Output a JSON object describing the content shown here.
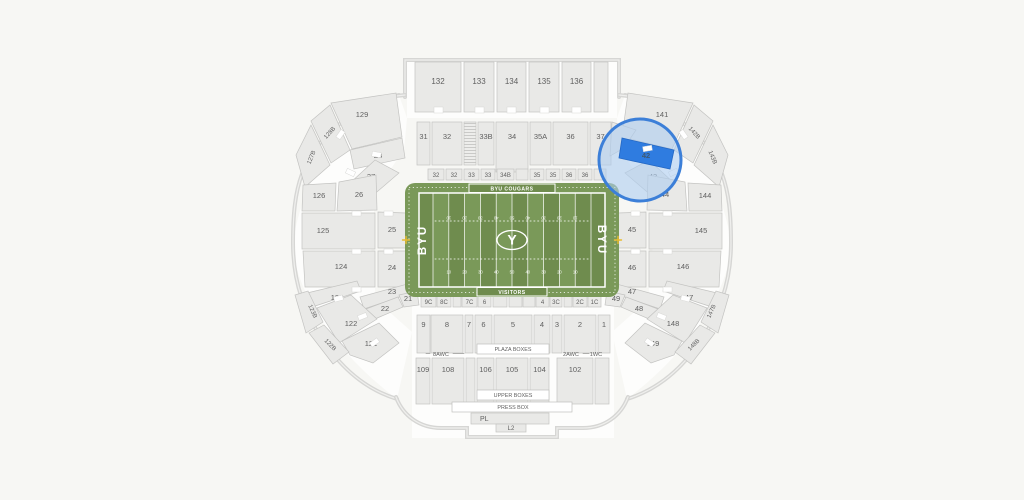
{
  "canvas": {
    "w": 1024,
    "h": 500,
    "bg": "#f7f7f4"
  },
  "colors": {
    "section": "#e9e9e7",
    "sectionStroke": "#c3c3c1",
    "wall": "#d6d6d4",
    "wallInner": "#efefed",
    "label": "#5f5f5f",
    "white": "#ffffff",
    "underlay": "#fdfdfc",
    "fieldBase": "#7a9959",
    "fieldDark": "#6f8c4e",
    "fieldLine": "#ffffff",
    "gold": "#e8bb30",
    "hlFill": "rgba(173,205,240,0.60)",
    "hlStroke": "#3c7fd8",
    "hlSection": "#2f7ce0",
    "hlSectionLabel": "#3f5a74"
  },
  "stadium": {
    "top_deck": {
      "y": 62,
      "h": 50,
      "label_y": 84,
      "boxes": [
        [
          "132",
          415,
          46
        ],
        [
          "133",
          464,
          30
        ],
        [
          "134",
          497,
          29
        ],
        [
          "135",
          529,
          30
        ],
        [
          "136",
          562,
          29
        ],
        [
          "",
          594,
          14
        ]
      ],
      "notch_y": 107,
      "notches_x": [
        438,
        479,
        511,
        544,
        576
      ]
    },
    "row2": {
      "y": 122,
      "h": 43,
      "label_y": 139,
      "boxes": [
        [
          "31",
          417,
          13,
          43
        ],
        [
          "32",
          432,
          30,
          43
        ],
        [
          "STAIRS",
          464,
          12,
          43
        ],
        [
          "33B",
          478,
          16,
          43
        ],
        [
          "34",
          496,
          32,
          50
        ],
        [
          "35A",
          530,
          21,
          43
        ],
        [
          "36",
          553,
          35,
          43
        ],
        [
          "37",
          590,
          21,
          43
        ]
      ]
    },
    "top_strip": {
      "y": 169,
      "h": 11,
      "label_y": 177,
      "boxes": [
        [
          "32",
          428,
          16
        ],
        [
          "32",
          446,
          16
        ],
        [
          "33",
          464,
          15
        ],
        [
          "33",
          481,
          14
        ],
        [
          "34B",
          497,
          17
        ],
        [
          "",
          516,
          12
        ],
        [
          "35",
          530,
          14
        ],
        [
          "35",
          546,
          14
        ],
        [
          "36",
          562,
          14
        ],
        [
          "36",
          578,
          14
        ],
        [
          "",
          594,
          12
        ]
      ]
    },
    "bottom_strip": {
      "y": 295,
      "h": 12,
      "label_y": 304,
      "boxes": [
        [
          "9C",
          421,
          15
        ],
        [
          "8C",
          437,
          14
        ],
        [
          "",
          453,
          8
        ],
        [
          "7C",
          462,
          15
        ],
        [
          "6",
          478,
          13
        ],
        [
          "",
          493,
          14
        ],
        [
          "",
          509,
          13
        ],
        [
          "",
          523,
          12
        ],
        [
          "4",
          536,
          13
        ],
        [
          "3C",
          550,
          12
        ],
        [
          "",
          564,
          8
        ],
        [
          "2C",
          573,
          14
        ],
        [
          "1C",
          588,
          13
        ]
      ]
    },
    "plaza_row": {
      "y": 315,
      "h": 38,
      "label_y": 327,
      "boxes": [
        [
          "9",
          417,
          13
        ],
        [
          "8",
          431,
          32
        ],
        [
          "7",
          465,
          8
        ],
        [
          "6",
          475,
          17
        ],
        [
          "5",
          494,
          38
        ],
        [
          "4",
          534,
          16
        ],
        [
          "3",
          552,
          10
        ],
        [
          "2",
          564,
          32
        ],
        [
          "1",
          598,
          12
        ]
      ],
      "band": {
        "label": "PLAZA BOXES",
        "x": 477,
        "y": 344,
        "w": 72,
        "h": 10,
        "label_x": 513,
        "label_y": 351
      },
      "wc_labels": [
        {
          "t": "8AWC",
          "x": 441,
          "y": 356
        },
        {
          "t": "2AWC",
          "x": 571,
          "y": 356
        },
        {
          "t": "1WC",
          "x": 596,
          "y": 356
        }
      ],
      "wc_dashes": [
        [
          453,
          353.5,
          464,
          353.5
        ],
        [
          583,
          353.5,
          589,
          353.5
        ],
        [
          426,
          353.5,
          430,
          353.5
        ]
      ]
    },
    "upper_row": {
      "y": 358,
      "h": 46,
      "label_y": 372,
      "boxes": [
        [
          "109",
          416,
          14
        ],
        [
          "108",
          432,
          32
        ],
        [
          "",
          466,
          9
        ],
        [
          "106",
          477,
          17
        ],
        [
          "105",
          496,
          32
        ],
        [
          "104",
          530,
          19
        ],
        [
          "102",
          557,
          36
        ],
        [
          "",
          595,
          14
        ]
      ],
      "band": {
        "label": "UPPER BOXES",
        "x": 477,
        "y": 390,
        "w": 72,
        "h": 10,
        "label_x": 513,
        "label_y": 397
      }
    },
    "press_box": {
      "band": {
        "label": "PRESS BOX",
        "x": 452,
        "y": 402,
        "w": 120,
        "h": 10,
        "label_x": 513,
        "label_y": 409
      },
      "pl": {
        "label": "PL",
        "x": 471,
        "y": 413,
        "w": 78,
        "h": 11,
        "label_x": 480,
        "label_y": 421
      },
      "l2": {
        "label": "L2",
        "x": 496,
        "y": 424,
        "w": 30,
        "h": 8,
        "label_x": 511,
        "label_y": 430
      }
    },
    "bowl": [
      {
        "l": "129",
        "m": "141",
        "pts": [
          [
            331,
            103
          ],
          [
            396,
            93
          ],
          [
            402,
            137
          ],
          [
            352,
            149
          ]
        ],
        "lp": [
          362,
          117
        ]
      },
      {
        "l": "128B",
        "m": "142B",
        "pts": [
          [
            311,
            121
          ],
          [
            330,
            105
          ],
          [
            350,
            150
          ],
          [
            331,
            163
          ]
        ],
        "lp": [
          331,
          134
        ],
        "rot": -48,
        "fs": 6
      },
      {
        "l": "127B",
        "m": "143B",
        "pts": [
          [
            296,
            155
          ],
          [
            311,
            125
          ],
          [
            330,
            165
          ],
          [
            305,
            187
          ]
        ],
        "lp": [
          313,
          158
        ],
        "rot": -68,
        "fs": 6
      },
      {
        "l": "28",
        "m": "42",
        "pts": [
          [
            350,
            150
          ],
          [
            402,
            138
          ],
          [
            405,
            158
          ],
          [
            354,
            169
          ]
        ],
        "lp": [
          378,
          158
        ]
      },
      {
        "l": "27",
        "m": "43",
        "pts": [
          [
            349,
            184
          ],
          [
            375,
            160
          ],
          [
            399,
            173
          ],
          [
            371,
            197
          ]
        ],
        "lp": [
          371,
          179
        ]
      },
      {
        "l": "26",
        "m": "44",
        "pts": [
          [
            339,
            182
          ],
          [
            376,
            175
          ],
          [
            377,
            210
          ],
          [
            337,
            211
          ]
        ],
        "lp": [
          359,
          197
        ]
      },
      {
        "l": "126",
        "m": "144",
        "pts": [
          [
            303,
            185
          ],
          [
            336,
            183
          ],
          [
            335,
            211
          ],
          [
            302,
            211
          ]
        ],
        "lp": [
          319,
          198
        ]
      },
      {
        "l": "25",
        "m": "45",
        "pts": [
          [
            378,
            212
          ],
          [
            406,
            213
          ],
          [
            406,
            248
          ],
          [
            378,
            248
          ]
        ],
        "lp": [
          392,
          232
        ]
      },
      {
        "l": "125",
        "m": "145",
        "pts": [
          [
            302,
            213
          ],
          [
            375,
            213
          ],
          [
            375,
            249
          ],
          [
            302,
            249
          ]
        ],
        "lp": [
          323,
          233
        ]
      },
      {
        "l": "24",
        "m": "46",
        "pts": [
          [
            378,
            251
          ],
          [
            406,
            251
          ],
          [
            406,
            287
          ],
          [
            378,
            287
          ]
        ],
        "lp": [
          392,
          270
        ]
      },
      {
        "l": "124",
        "m": "146",
        "pts": [
          [
            303,
            251
          ],
          [
            375,
            251
          ],
          [
            375,
            287
          ],
          [
            305,
            287
          ]
        ],
        "lp": [
          341,
          269
        ]
      },
      {
        "l": "23",
        "m": "47",
        "pts": [
          [
            360,
            297
          ],
          [
            411,
            283
          ],
          [
            414,
            292
          ],
          [
            364,
            309
          ]
        ],
        "lp": [
          392,
          294
        ]
      },
      {
        "l": "123",
        "m": "147",
        "pts": [
          [
            307,
            293
          ],
          [
            357,
            281
          ],
          [
            361,
            291
          ],
          [
            312,
            307
          ]
        ],
        "lp": [
          337,
          300
        ]
      },
      {
        "l": "21",
        "m": "49",
        "pts": [
          [
            399,
            295
          ],
          [
            417,
            291
          ],
          [
            419,
            305
          ],
          [
            404,
            307
          ]
        ],
        "lp": [
          408,
          301
        ]
      },
      {
        "l": "22",
        "m": "48",
        "pts": [
          [
            350,
            315
          ],
          [
            398,
            297
          ],
          [
            403,
            307
          ],
          [
            356,
            327
          ]
        ],
        "lp": [
          385,
          311
        ]
      },
      {
        "l": "122",
        "m": "148",
        "pts": [
          [
            317,
            308
          ],
          [
            351,
            295
          ],
          [
            377,
            319
          ],
          [
            339,
            343
          ]
        ],
        "lp": [
          351,
          326
        ]
      },
      {
        "l": "121",
        "m": "149",
        "pts": [
          [
            342,
            341
          ],
          [
            379,
            323
          ],
          [
            399,
            343
          ],
          [
            373,
            363
          ],
          [
            350,
            355
          ]
        ],
        "lp": [
          371,
          346
        ]
      },
      {
        "l": "123B",
        "m": "147B",
        "pts": [
          [
            295,
            295
          ],
          [
            308,
            291
          ],
          [
            323,
            322
          ],
          [
            306,
            333
          ]
        ],
        "lp": [
          311,
          312
        ],
        "rot": 66,
        "fs": 6
      },
      {
        "l": "122B",
        "m": "148B",
        "pts": [
          [
            309,
            333
          ],
          [
            324,
            325
          ],
          [
            349,
            352
          ],
          [
            333,
            364
          ]
        ],
        "lp": [
          329,
          346
        ],
        "rot": 46,
        "fs": 6
      }
    ],
    "corner_filler": [
      [
        612,
        122
      ],
      [
        636,
        130
      ],
      [
        624,
        148
      ],
      [
        610,
        156
      ]
    ],
    "notches": [
      [
        352,
        211,
        0
      ],
      [
        384,
        211,
        0
      ],
      [
        352,
        249,
        0
      ],
      [
        384,
        249,
        0
      ],
      [
        352,
        287,
        0
      ],
      [
        334,
        296,
        -15
      ],
      [
        358,
        314,
        -22
      ],
      [
        370,
        340,
        -35
      ],
      [
        346,
        170,
        25
      ],
      [
        372,
        152,
        10
      ],
      [
        336,
        132,
        -55
      ]
    ]
  },
  "field": {
    "x": 405,
    "y": 183,
    "w": 214,
    "h": 114,
    "inner": {
      "x": 419,
      "y": 193,
      "w": 186,
      "h": 94
    },
    "home_band": {
      "label": "BYU COUGARS",
      "x": 469,
      "y": 184,
      "w": 86,
      "h": 8.5,
      "label_x": 512,
      "label_y": 190.5
    },
    "visitor_band": {
      "label": "VISITORS",
      "x": 477,
      "y": 287.5,
      "w": 70,
      "h": 8.5,
      "label_x": 512,
      "label_y": 294
    },
    "endzone_left": "BYU",
    "endzone_right": "BYU",
    "center_logo": "Y",
    "yard_numbers": [
      "10",
      "20",
      "30",
      "40",
      "50",
      "40",
      "30",
      "20",
      "10"
    ],
    "num_rows_y": [
      216.5,
      273.5
    ],
    "hash_y": [
      221,
      259
    ]
  },
  "highlight": {
    "circle": {
      "cx": 640,
      "cy": 160,
      "r": 41
    },
    "selected_section": "42",
    "adjacent_section": "43"
  }
}
